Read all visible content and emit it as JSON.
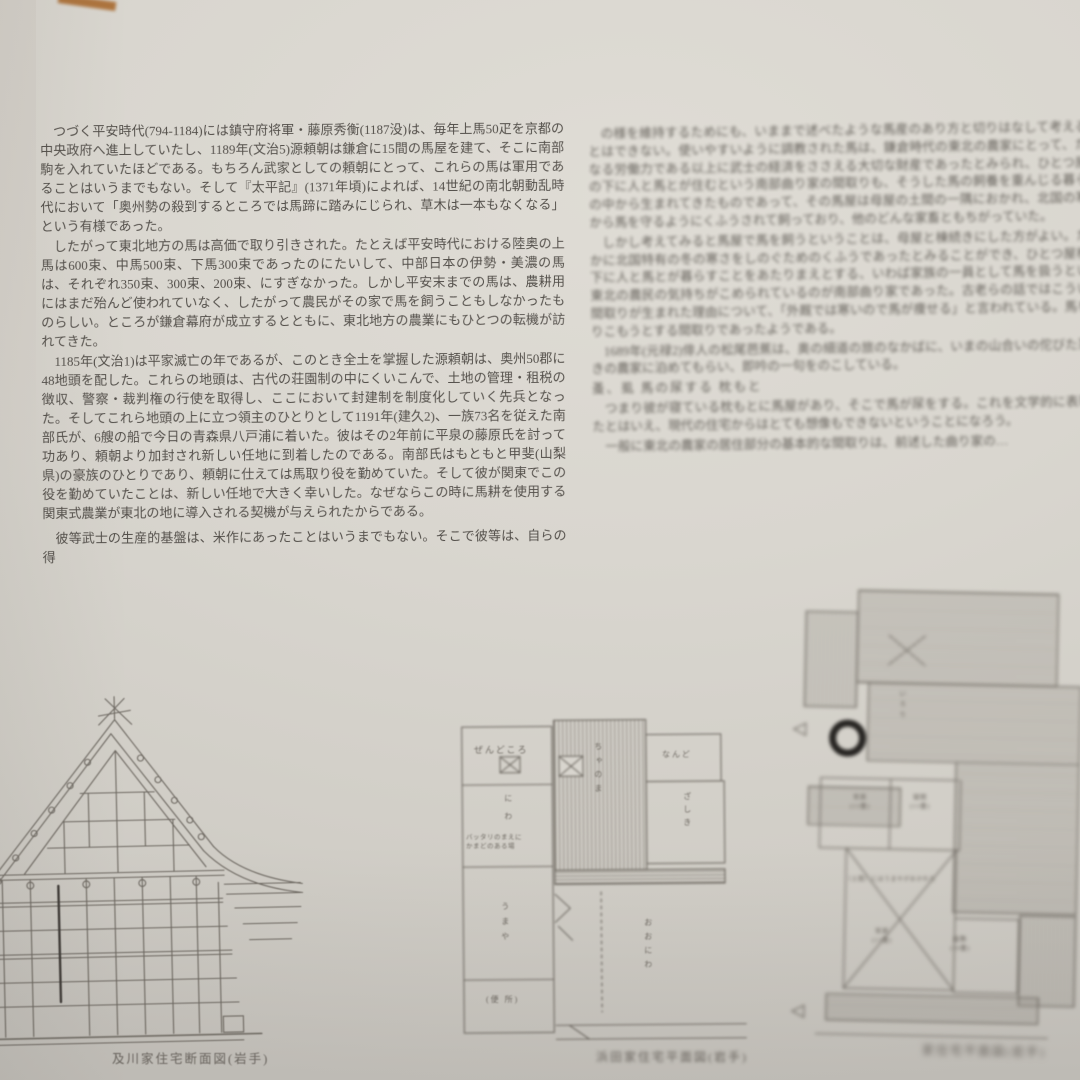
{
  "left_column": {
    "p1": "つづく平安時代(794-1184)には鎮守府将軍・藤原秀衡(1187没)は、毎年上馬50疋を京都の中央政府へ進上していたし、1189年(文治5)源頼朝は鎌倉に15間の馬屋を建て、そこに南部駒を入れていたほどである。もちろん武家としての頼朝にとって、これらの馬は軍用であることはいうまでもない。そして『太平記』(1371年頃)によれば、14世紀の南北朝動乱時代において「奥州勢の殺到するところでは馬蹄に踏みにじられ、草木は一本もなくなる」という有様であった。",
    "p2": "したがって東北地方の馬は高価で取り引きされた。たとえば平安時代における陸奥の上馬は600束、中馬500束、下馬300束であったのにたいして、中部日本の伊勢・美濃の馬は、それぞれ350束、300束、200束、にすぎなかった。しかし平安末までの馬は、農耕用にはまだ殆んど使われていなく、したがって農民がその家で馬を飼うこともしなかったものらしい。ところが鎌倉幕府が成立するとともに、東北地方の農業にもひとつの転機が訪れてきた。",
    "p3": "1185年(文治1)は平家滅亡の年であるが、このとき全土を掌握した源頼朝は、奥州50郡に48地頭を配した。これらの地頭は、古代の荘園制の中にくいこんで、土地の管理・租税の徴収、警察・裁判権の行使を取得し、ここにおいて封建制を制度化していく先兵となった。そしてこれら地頭の上に立つ領主のひとりとして1191年(建久2)、一族73名を従えた南部氏が、6艘の船で今日の青森県八戸浦に着いた。彼はその2年前に平泉の藤原氏を討って功あり、頼朝より加封され新しい任地に到着したのである。南部氏はもともと甲斐(山梨県)の豪族のひとりであり、頼朝に仕えては馬取り役を勤めていた。そして彼が関東でこの役を勤めていたことは、新しい任地で大きく幸いした。なぜならこの時に馬耕を使用する関東式農業が東北の地に導入される契機が与えられたからである。",
    "p4": "彼等武士の生産的基盤は、米作にあったことはいうまでもない。そこで彼等は、自らの得"
  },
  "right_column": {
    "p1": "の様を維持するためにも、いままで述べたような馬産のあり方と切りはなして考えることはできない。使いやすいように調教された馬は、鎌倉時代の東北の農家にとって、たんなる労働力である以上に武士の経済をささえる大切な財産であったとみられ、ひとつ屋根の下に人と馬とが住むという南部曲り家の間取りも、そうした馬の飼養を重んじる暮らしの中から生まれてきたものであって、その馬屋は母屋の土間の一隅におかれ、北国の寒さから馬を守るようにくふうされて飼っており、他のどんな家畜ともちがっていた。",
    "p2": "しかし考えてみると馬屋で馬を飼うということは、母屋と棟続きにした方がよい。たしかに北国特有の冬の寒さをしのぐためのくふうであったとみることができ、ひとつ屋根の下に人と馬とが暮らすことをあたりまえとする、いわば家族の一員として馬を扱うという東北の農民の気持ちがこめられているのが南部曲り家であった。古老らの話ではこういう間取りが生まれた理由について、「外厩では寒いので馬が痩せる」と言われている。馬をとりこもうとする間取りであったようである。",
    "p3": "1689年(元禄2)俳人の松尾芭蕉は、奥の細道の旅のなかばに、いまの山合いの佗びた茅ぶきの農家に泊めてもらい、即吟の一句をのこしている。",
    "haiku": "蚤、虱 馬の尿する 枕もと",
    "p4": "つまり彼が寝ている枕もとに馬屋があり、そこで馬が尿をする。これを文学的に表現したとはいえ、現代の住宅からはとても想像もできないということになろう。",
    "p5": "一般に東北の農家の居住部分の基本的な間取りは、前述した曲り家の…"
  },
  "figures": {
    "cross_section": {
      "caption": "及川家住宅断面図(岩手)"
    },
    "plan_center": {
      "caption": "浜田家住宅平面図(岩手)",
      "labels": {
        "zendokoro": "ぜんどころ",
        "niwa": "にわ",
        "chanoma": "ちゃのま",
        "nando": "なんど",
        "zashiki": "ざしき",
        "umaya": "うまや",
        "benjo": "(便 所)",
        "oniwa": "おおにわ",
        "note": "バッタリのまえに\nかまどのある場"
      }
    },
    "plan_right": {
      "caption": "家住宅平面図(岩手)",
      "labels": {
        "room1": "常居\n(13畳)",
        "room2": "寝間\n(13畳)",
        "room3": "常居\n(13畳)",
        "room4": "座敷\n(10畳)",
        "doma": "（土間）にはうまやがおかれた",
        "irori": "いろり"
      }
    }
  }
}
